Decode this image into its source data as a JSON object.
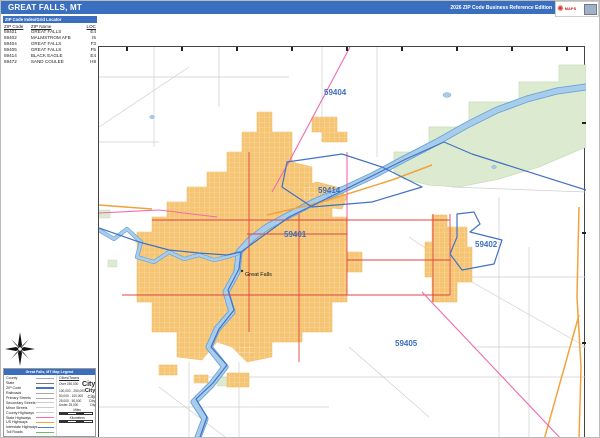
{
  "header": {
    "title": "GREAT FALLS, MT",
    "edition": "2026 ZIP Code Business Reference Edition"
  },
  "brand": {
    "name": "MarketMAPS",
    "maps": "MAPS"
  },
  "index_table": {
    "title": "ZIP Code Index/Grid Locator",
    "columns": {
      "zip": "ZIP Code",
      "name": "ZIP Name",
      "loc": "LOC"
    },
    "rows": [
      {
        "zip": "59401",
        "name": "GREAT FALLS",
        "loc": "E4"
      },
      {
        "zip": "59402",
        "name": "MALMSTROM AFB",
        "loc": "I5"
      },
      {
        "zip": "59404",
        "name": "GREAT FALLS",
        "loc": "F3"
      },
      {
        "zip": "59405",
        "name": "GREAT FALLS",
        "loc": "F5"
      },
      {
        "zip": "59414",
        "name": "BLACK EAGLE",
        "loc": "E4"
      },
      {
        "zip": "59472",
        "name": "SAND COULEE",
        "loc": "H8"
      }
    ]
  },
  "map": {
    "zip_labels": [
      {
        "text": "59404"
      },
      {
        "text": "59414"
      },
      {
        "text": "59401"
      },
      {
        "text": "59402"
      },
      {
        "text": "59405"
      }
    ],
    "city_label": "Great Falls"
  },
  "legend": {
    "title": "Great Falls, MT Map Legend",
    "items": [
      {
        "label": "County"
      },
      {
        "label": "State"
      },
      {
        "label": "ZIP Code"
      },
      {
        "label": "Railroads"
      },
      {
        "label": "Primary Streets"
      },
      {
        "label": "Secondary Streets"
      },
      {
        "label": "Minor Streets"
      },
      {
        "label": "County Highways"
      },
      {
        "label": "State Highways"
      },
      {
        "label": "US Highways"
      },
      {
        "label": "Interstate Highways"
      },
      {
        "label": "Toll Roads"
      }
    ],
    "cities_heading": "Cities/Towns",
    "city_classes": [
      {
        "range": "Over 250,000",
        "sample": "City"
      },
      {
        "range": "100,000 - 250,000",
        "sample": "City"
      },
      {
        "range": "50,000 - 100,000",
        "sample": "City"
      },
      {
        "range": "25,000 - 50,000",
        "sample": "City"
      },
      {
        "range": "Under 25,000",
        "sample": "City"
      }
    ],
    "scale": {
      "miles": "Miles",
      "km": "Kilometers"
    }
  },
  "colors": {
    "header_blue": "#3a6fc0",
    "urban_fill": "#f6c573",
    "river_blue": "#a8cdea",
    "river_edge": "#6aa3d8",
    "park_green": "#dcead0",
    "zip_boundary": "#4472c4",
    "zip_label": "#3a6ebf",
    "primary_street_red": "#e04545",
    "us_highway_orange": "#f2a33c",
    "state_highway_pink": "#ef6ab0",
    "minor_road_gray": "#cfcfcf"
  }
}
